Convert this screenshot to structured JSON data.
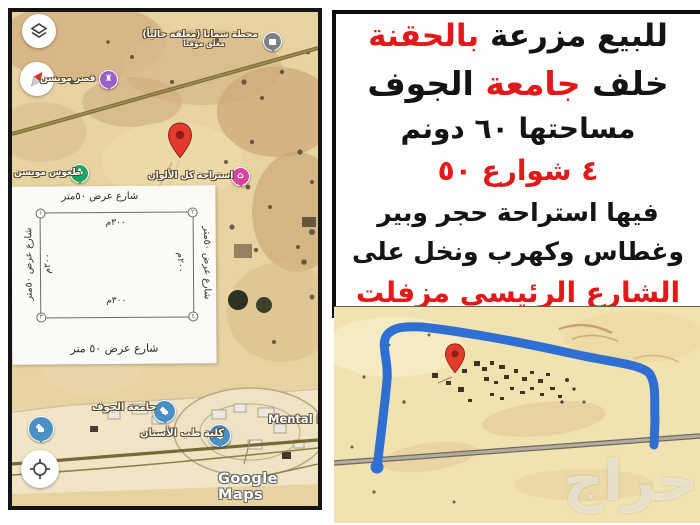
{
  "colors": {
    "ad_red": "#e01a1a",
    "ad_black": "#141414",
    "blue_outline": "#2f6fd3",
    "pin_red": "#e23b2e",
    "sand": "#e7d3a2",
    "sand_light": "#f1e3b1"
  },
  "left_map": {
    "labels": {
      "station_title": "محطة سمانا (مغلقه حالياً)",
      "station_sub": "مغلق مؤقتاً",
      "palace": "قصر مويسن",
      "dunes": "طعوس مويسن",
      "resthouse": "استراحة كل الألوان",
      "university": "جامعة الجوف",
      "dentistry": "كلية طب الأسنان",
      "mental": "Mental H",
      "google_watermark": "Google Maps"
    },
    "inset": {
      "top_street": "شارع عرض ٥٠متر",
      "bottom_street": "شارع عرض ٥٠ متر",
      "left_street": "شارع عرض ٥٠متر",
      "right_street": "شارع عرض ٥٠متر",
      "top_dim": "٣٠٠م",
      "bottom_dim": "٣٠٠م",
      "left_dim": "٢٠٠م",
      "right_dim": "٢٠٠م",
      "corners": [
        "١",
        "٢",
        "٣",
        "٤"
      ]
    }
  },
  "ad": {
    "line1_black": "للبيع مزرعة ",
    "line1_red": "بالحقنة",
    "line2_pre": "خلف ",
    "line2_red": "جامعة ",
    "line2_post": "الجوف",
    "line3": "مساحتها ٦٠ دونم",
    "line4": "٤ شوارع ٥٠",
    "line5": "فيها استراحة حجر وبير",
    "line6": "وغطاس وكهرب ونخل على",
    "line7": "الشارع الرئيسي مزفلت"
  },
  "bottom_map": {
    "watermark": "حراج"
  }
}
